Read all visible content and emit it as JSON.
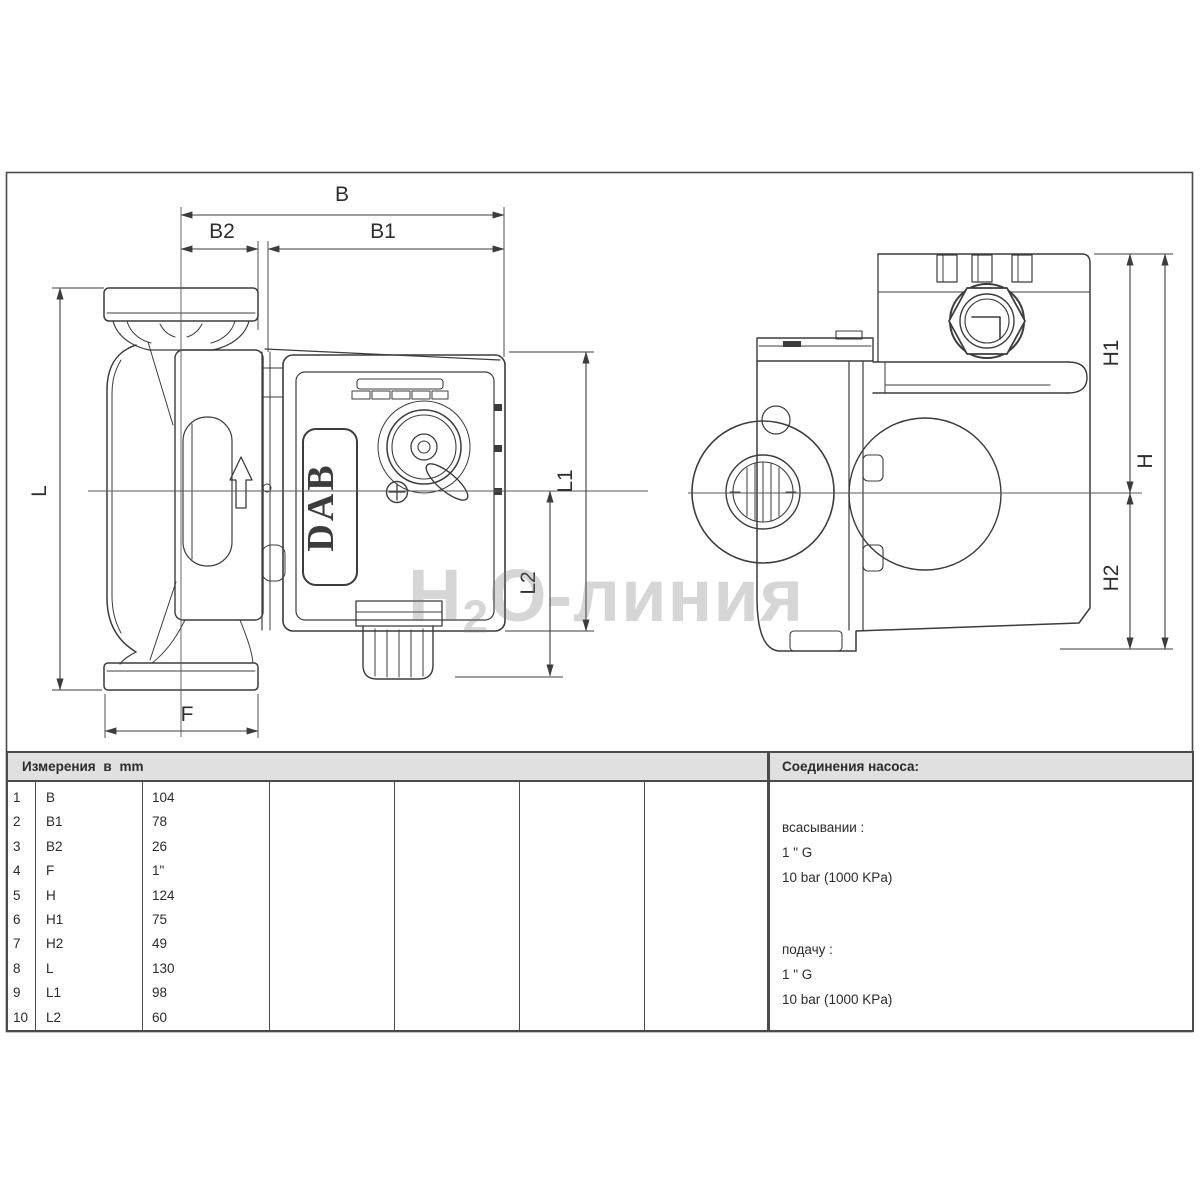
{
  "drawing": {
    "dimension_labels": {
      "B": "B",
      "B1": "B1",
      "B2": "B2",
      "L": "L",
      "L1": "L1",
      "L2": "L2",
      "F": "F",
      "H": "H",
      "H1": "H1",
      "H2": "H2"
    },
    "logo_text": "DAB",
    "watermark": {
      "prefix": "H",
      "subscript": "2",
      "suffix": "O-линия"
    }
  },
  "table": {
    "measurements_header": "Измерения в mm",
    "connections_header": "Соединения насоса:",
    "rows": [
      {
        "num": "1",
        "label": "B",
        "value": "104"
      },
      {
        "num": "2",
        "label": "B1",
        "value": "78"
      },
      {
        "num": "3",
        "label": "B2",
        "value": "26"
      },
      {
        "num": "4",
        "label": "F",
        "value": "1\""
      },
      {
        "num": "5",
        "label": "H",
        "value": "124"
      },
      {
        "num": "6",
        "label": "H1",
        "value": "75"
      },
      {
        "num": "7",
        "label": "H2",
        "value": "49"
      },
      {
        "num": "8",
        "label": "L",
        "value": "130"
      },
      {
        "num": "9",
        "label": "L1",
        "value": "98"
      },
      {
        "num": "10",
        "label": "L2",
        "value": "60"
      }
    ],
    "connections": {
      "suction_label": "всасывании :",
      "suction_size": "1 \" G",
      "suction_pressure": "10 bar (1000 KPa)",
      "delivery_label": "подачу :",
      "delivery_size": "1 \" G",
      "delivery_pressure": "10 bar (1000 KPa)"
    }
  },
  "colors": {
    "line": "#3c3c3c",
    "dim": "#444444",
    "header_bg": "#e0e0e0",
    "border": "#4a4a4a",
    "watermark": "#cccccc"
  }
}
